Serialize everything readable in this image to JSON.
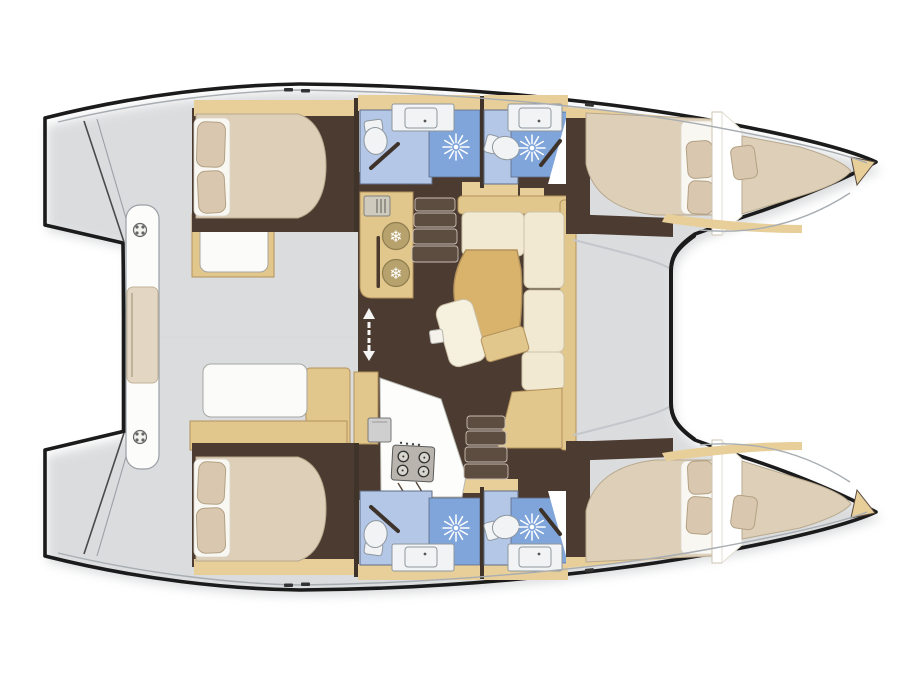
{
  "diagram": {
    "type": "boat-floorplan",
    "subject": "catamaran sailing yacht deck and accommodation plan, bows to the right",
    "hulls": 2
  },
  "icons": {
    "snowflake": "❄",
    "shower": "starburst-rays",
    "toilet": "oval-bowl-with-tank",
    "sink": "rounded-rect-with-dot",
    "stove": "four-burner-circles",
    "cleat": "circle-with-four-dots"
  },
  "features": {
    "double_beds": 4,
    "bow_peak_berths": 2,
    "toilets": 4,
    "showers": 4,
    "bathroom_sinks": 4,
    "galley_sinks": 1,
    "fridge_discs": 2,
    "stove_burners": 4,
    "companionway_flights": 2,
    "settee_cushions": 4,
    "stern_bench_cleats": 2
  },
  "colors": {
    "page_bg": "#ffffff",
    "outline": "#1b1b1b",
    "deck_white": "#fdfdfc",
    "floor_dark": "#4c3b31",
    "floor_step": "#5d4c40",
    "step_edge": "#c9beb2",
    "wood": "#e2c78c",
    "wood_dark": "#d9b26b",
    "wood_edge": "#b2925c",
    "wall_beige": "#e8cf9a",
    "wall_dark": "#3f332a",
    "cream": "#f1e9d2",
    "cream_edge": "#cdc3a8",
    "bed": "#ded0b8",
    "bed_edge": "#b8a88d",
    "pillow": "#d9c8af",
    "pillow_edge": "#b3a184",
    "backing": "#f8f7f2",
    "bath_floor": "#b4c7e7",
    "shower_floor": "#7fa5da",
    "room_edge": "#5e6d84",
    "fixture_white": "#f2f3f4",
    "fixture_edge": "#8d979e",
    "appliance_gray": "#b9b5ae",
    "fridge_disc": "#b7a26d",
    "line_gray": "#a8adb2",
    "shadow_gray": "#c3c7cb",
    "door_bar": "#3d332b",
    "arrow": "#f5f5f5",
    "boat_shadow": "#8a8f94"
  }
}
